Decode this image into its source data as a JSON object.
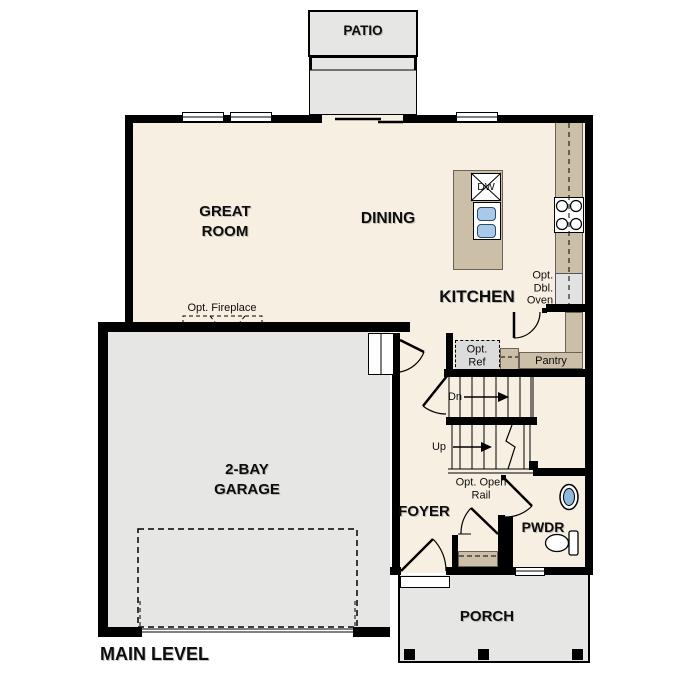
{
  "plan": {
    "title": "MAIN LEVEL",
    "rooms": {
      "patio": {
        "label": "PATIO"
      },
      "great_room": {
        "line1": "GREAT",
        "line2": "ROOM"
      },
      "dining": {
        "label": "DINING"
      },
      "kitchen": {
        "label": "KITCHEN"
      },
      "garage": {
        "line1": "2-BAY",
        "line2": "GARAGE"
      },
      "foyer": {
        "label": "FOYER"
      },
      "powder": {
        "label": "PWDR"
      },
      "porch": {
        "label": "PORCH"
      },
      "pantry": {
        "label": "Pantry"
      }
    },
    "annotations": {
      "fireplace": "Opt. Fireplace",
      "ref_line1": "Opt.",
      "ref_line2": "Ref",
      "dbl_oven_line1": "Opt.",
      "dbl_oven_line2": "Dbl.",
      "dbl_oven_line3": "Oven",
      "open_rail_line1": "Opt. Open",
      "open_rail_line2": "Rail",
      "stairs_down": "Dn",
      "stairs_up": "Up",
      "dishwasher": "DW"
    },
    "colors": {
      "floor_cream": "#f7efe2",
      "counter_tan": "#cbbfa8",
      "concrete_gray": "#e6e6e4",
      "sink_blue": "#a9c9e9",
      "fixture_blue": "#8fb8e0",
      "appliance_gray": "#e2e2e2",
      "ref_gray": "#dcdcdc",
      "wall_black": "#000000"
    }
  }
}
